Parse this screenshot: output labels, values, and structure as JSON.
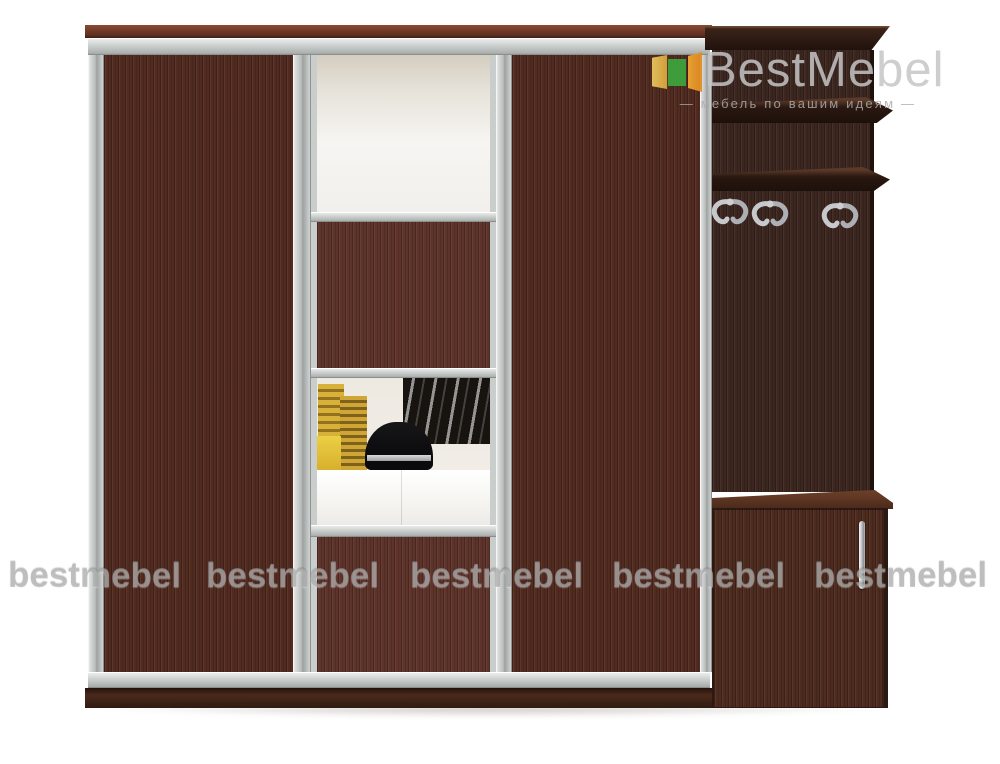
{
  "brand": {
    "name": "BestMebel",
    "tagline": "—  мебель по вашим идеям  —"
  },
  "watermarks": {
    "items": [
      "bestmebel",
      "bestmebel",
      "bestmebel",
      "bestmebel",
      "bestmebel"
    ]
  },
  "colors": {
    "wood_door": "#522b20",
    "wood_panel": "#5e332a",
    "wood_unit": "#3c2620",
    "wood_cabinet": "#4d2b1e",
    "accent_green": "#3da33c",
    "accent_orange": "#ef9b2c",
    "accent_gold": "#e3bb4e",
    "aluminum": "#c6cac8",
    "logo_gray": "#c5c5c5",
    "watermark_gray": "#a8a8a8",
    "chrome": "#c0c1c5",
    "background": "#ffffff"
  }
}
